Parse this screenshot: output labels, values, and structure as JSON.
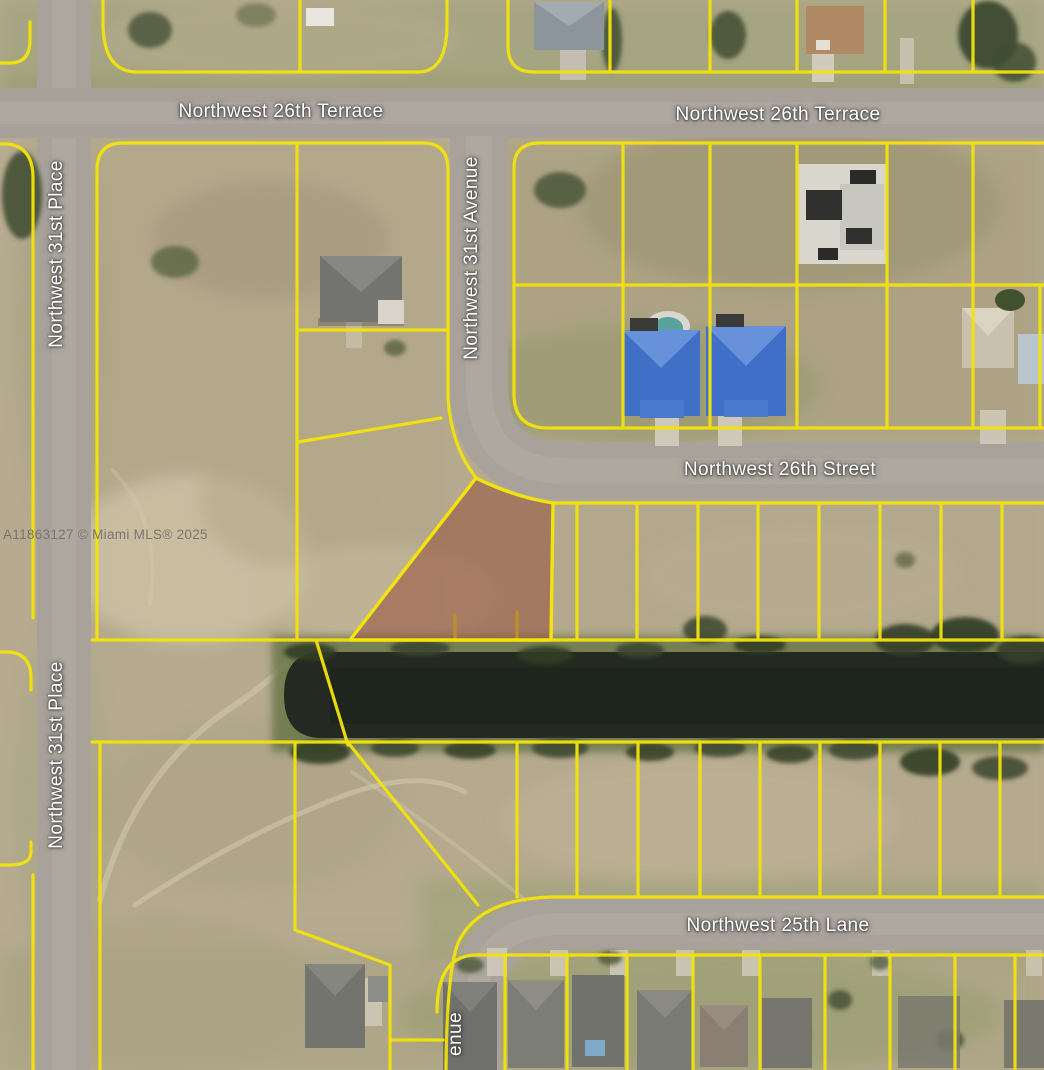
{
  "map": {
    "watermark": "A11863127 © Miami MLS® 2025",
    "streets": {
      "terrace_left": "Northwest 26th Terrace",
      "terrace_right": "Northwest 26th Terrace",
      "avenue_31st": "Northwest 31st Avenue",
      "place_31st_upper": "Northwest 31st Place",
      "place_31st_lower": "Northwest 31st Place",
      "street_26th": "Northwest 26th Street",
      "lane_25th": "Northwest 25th Lane",
      "avenue_partial": "enue"
    },
    "colors": {
      "lot_line": "#f3e30b",
      "parcel_highlight": "#94503a",
      "canal_water": "#242a21",
      "road_surface": "#a8a29a",
      "street_label": "#ffffff",
      "watermark_text": "#6f6b63"
    }
  }
}
